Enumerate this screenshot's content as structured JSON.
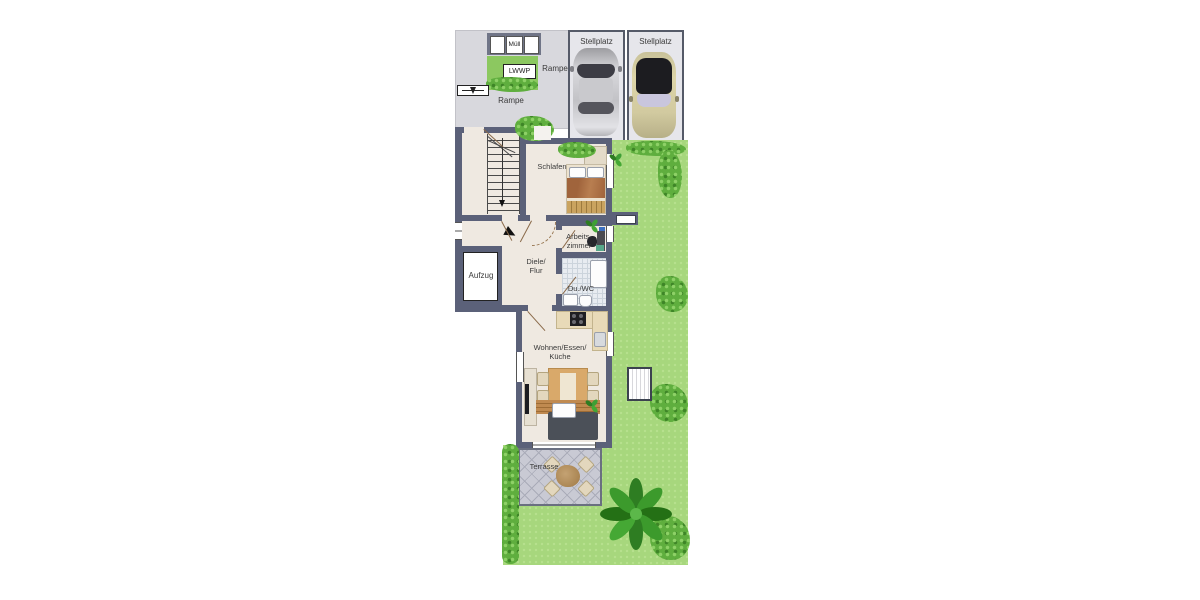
{
  "labels": {
    "muell": "Müll",
    "lwwp": "LWWP",
    "rampe_upper": "Rampe",
    "rampe_lower": "Rampe",
    "stellplatz_1": "Stellplatz",
    "stellplatz_2": "Stellplatz",
    "schlafen": "Schlafen",
    "arbeitszimmer_l1": "Arbeits-",
    "arbeitszimmer_l2": "zimmer",
    "diele_l1": "Diele/",
    "diele_l2": "Flur",
    "aufzug": "Aufzug",
    "du_wc": "Du./WC",
    "wohnen_l1": "Wohnen/Essen/",
    "wohnen_l2": "Küche",
    "terrasse": "Terrasse"
  },
  "colors": {
    "wall": "#5b6179",
    "floor": "#efe9e1",
    "garden": "#a7d77d",
    "bush_dark": "#3e8527",
    "bush_light": "#8ed167",
    "driveway": "#d8d8dd",
    "stall_fill": "#e6e6eb",
    "stall_border": "#555a68",
    "terrace": "#c9cad4",
    "wood": "#c08a50",
    "sofa": "#4b5058",
    "bed_blanket": "#a0643c",
    "car_silver": "#c6c6ca",
    "car_champagne": "#d8d0a2"
  }
}
